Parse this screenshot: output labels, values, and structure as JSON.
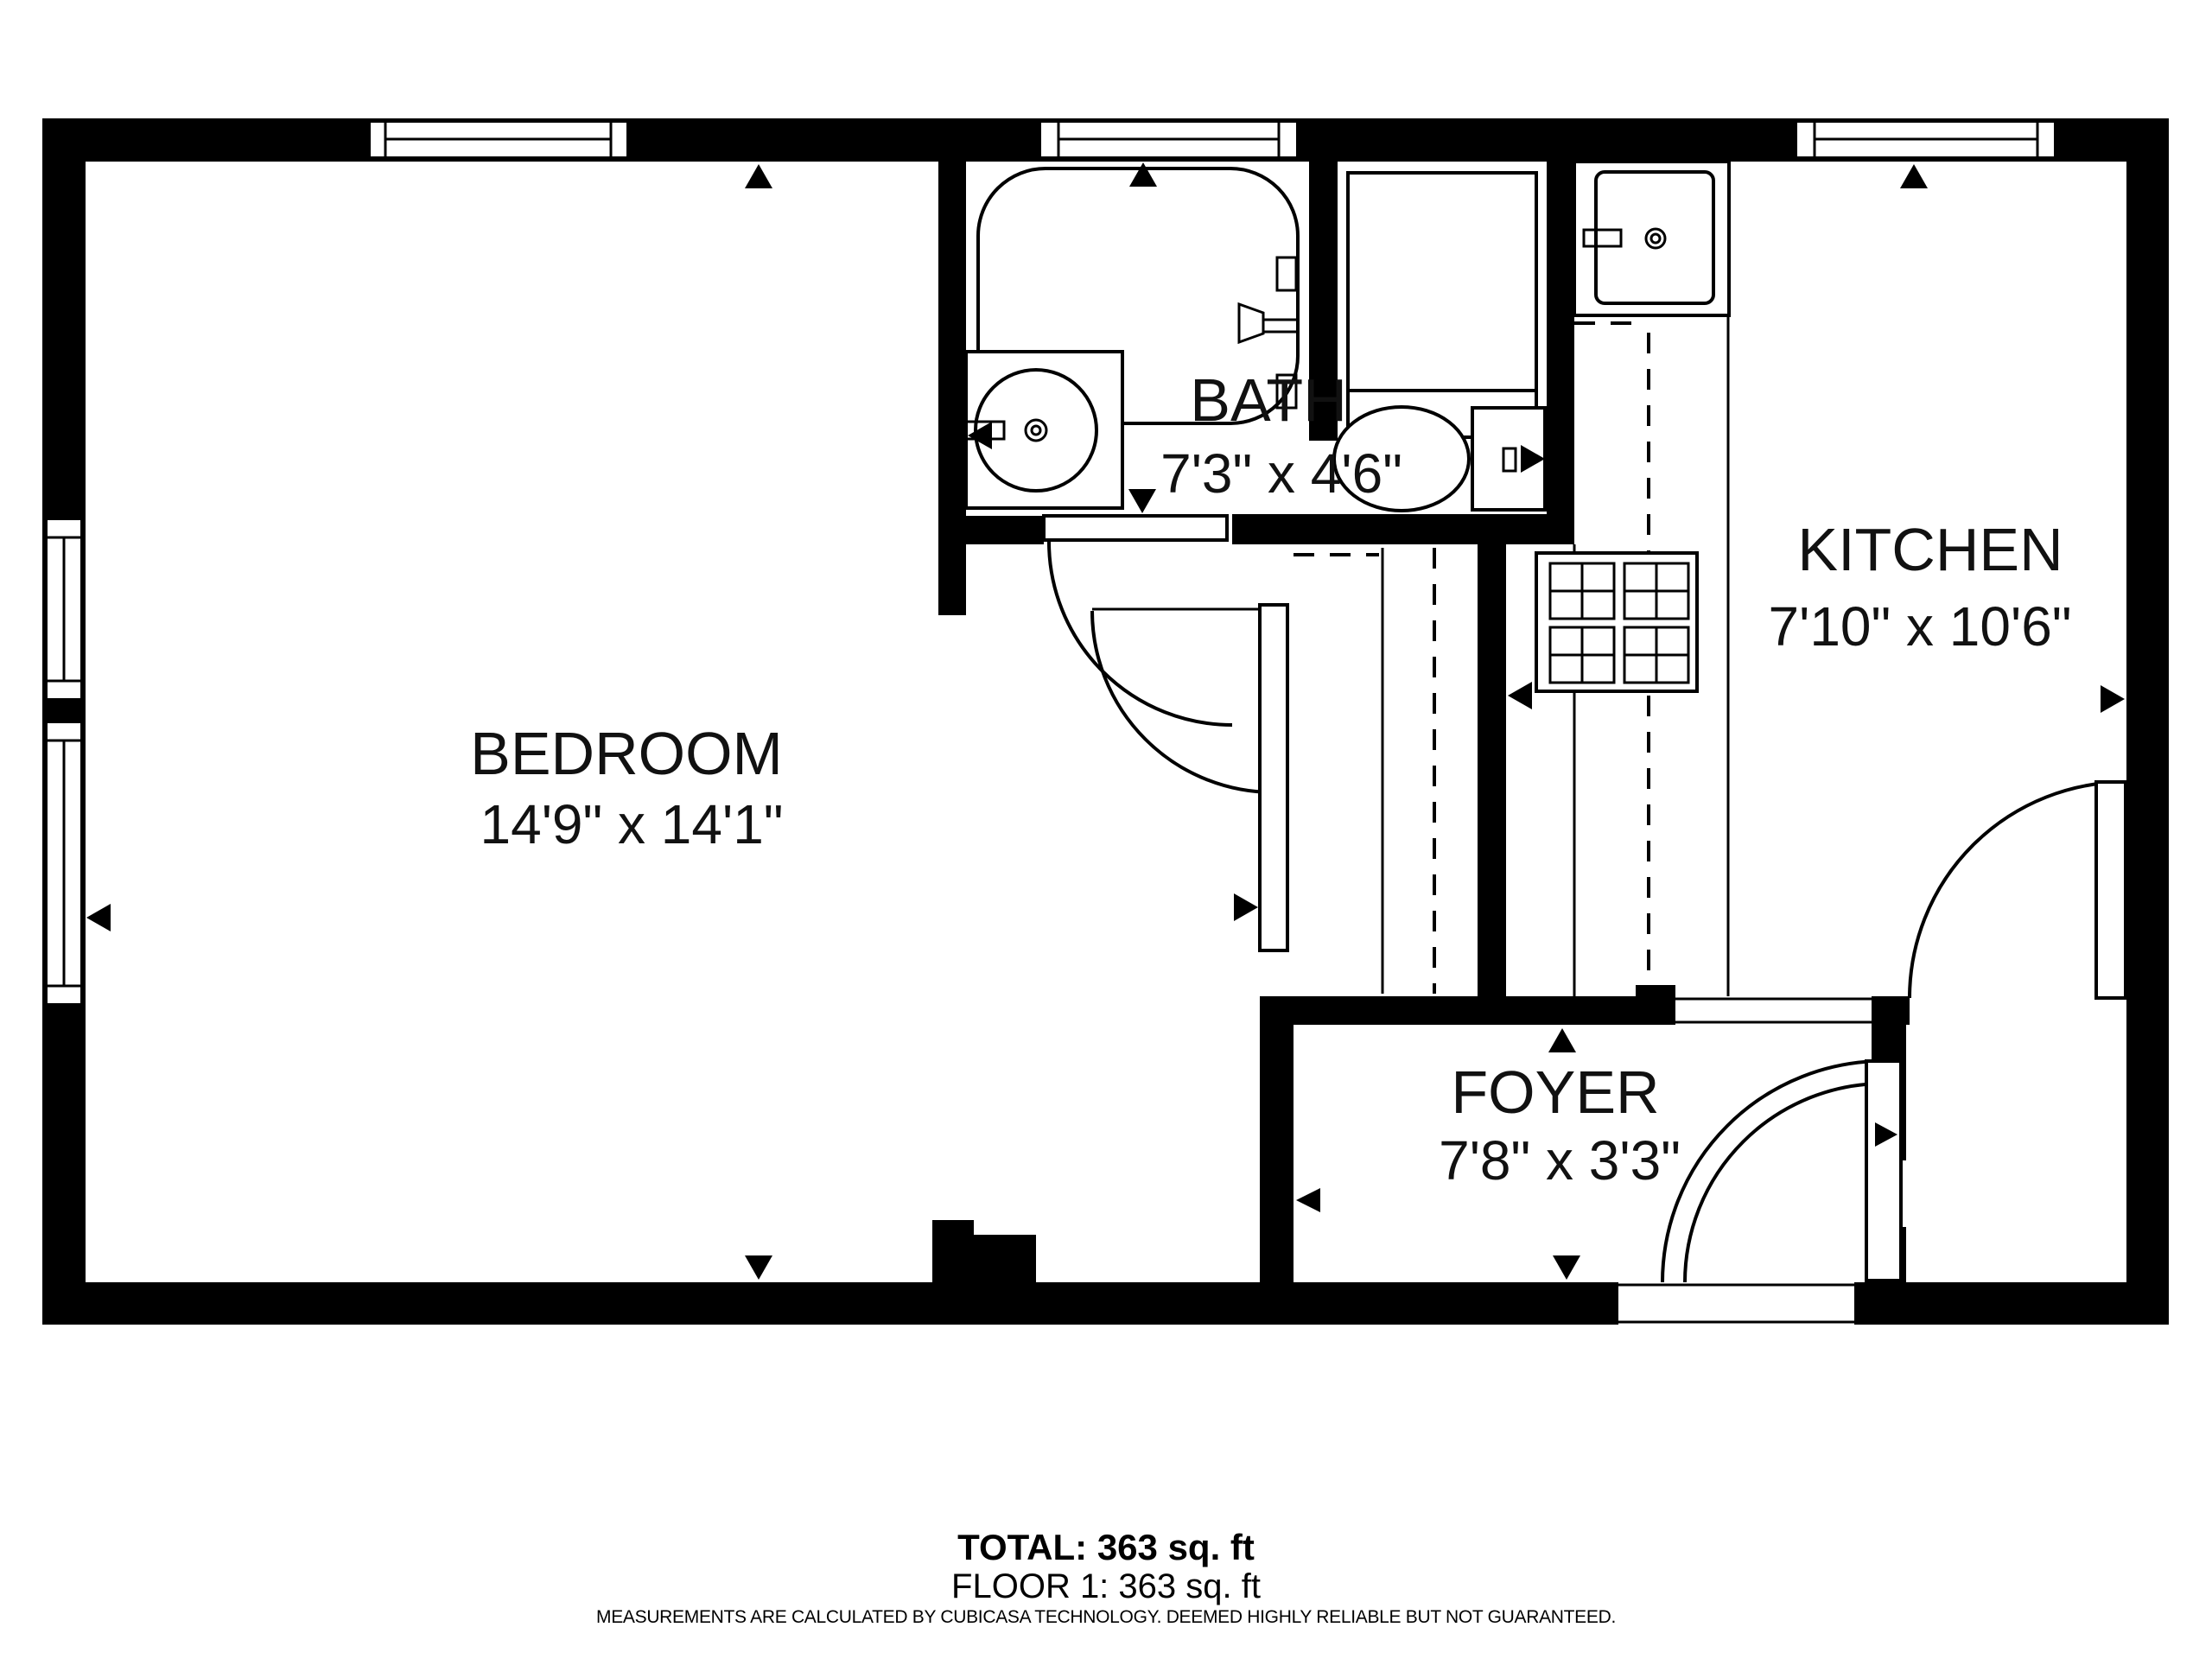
{
  "floor_plan": {
    "colors": {
      "wall": "#000000",
      "background": "#ffffff",
      "text": "#111111"
    },
    "rooms": [
      {
        "name": "BEDROOM",
        "dimensions": "14'9\" x 14'1\""
      },
      {
        "name": "BATH",
        "dimensions": "7'3\" x 4'6\""
      },
      {
        "name": "KITCHEN",
        "dimensions": "7'10\" x 10'6\""
      },
      {
        "name": "FOYER",
        "dimensions": "7'8\" x 3'3\""
      }
    ],
    "fixtures": [
      "bathtub",
      "shower",
      "bathroom-sink-vanity",
      "toilet",
      "kitchen-sink",
      "stove-4-burners",
      "kitchen-counter-dashed",
      "wardrobe-closet-dashed",
      "entry-door",
      "interior-doors",
      "windows-top-wall-x3",
      "windows-left-wall-x2"
    ]
  },
  "summary": {
    "total": "TOTAL: 363 sq. ft",
    "floor": "FLOOR 1: 363 sq. ft",
    "disclaimer": "MEASUREMENTS ARE CALCULATED BY CUBICASA TECHNOLOGY. DEEMED HIGHLY RELIABLE BUT NOT GUARANTEED."
  }
}
